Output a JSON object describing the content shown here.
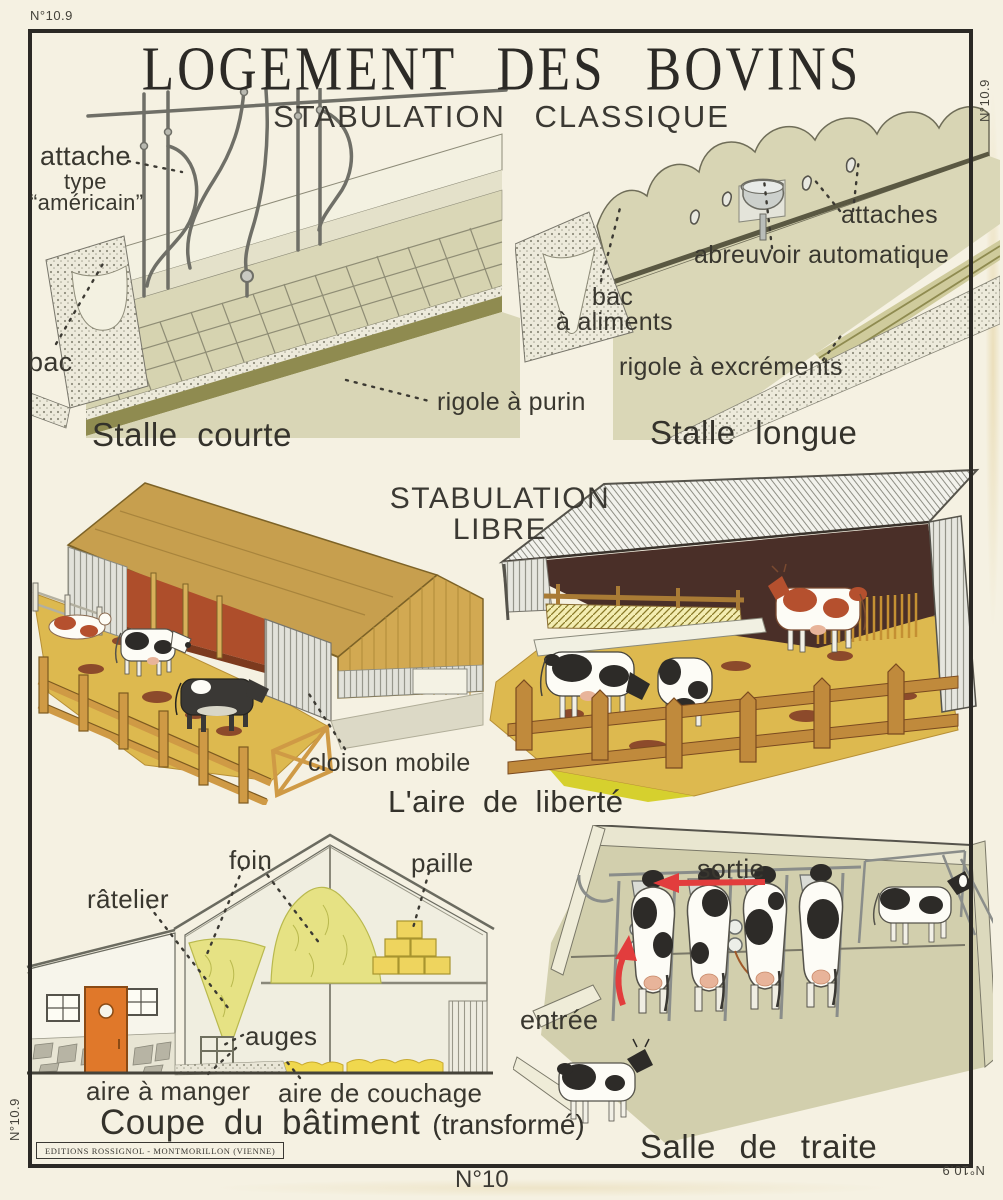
{
  "page": {
    "plate_mark": "N°10.9",
    "sheet_number": "N°10",
    "publisher": "EDITIONS ROSSIGNOL - MONTMORILLON (VIENNE)"
  },
  "header": {
    "title": "LOGEMENT DES BOVINS",
    "subtitle": "STABULATION CLASSIQUE"
  },
  "stalle_courte": {
    "caption": "Stalle courte",
    "label_attache": "attache",
    "label_attache_type_line1": "type",
    "label_attache_type_line2": "“américain”",
    "label_bac": "bac",
    "label_rigole_purin": "rigole à purin"
  },
  "stalle_longue": {
    "caption": "Stalle longue",
    "label_attaches": "attaches",
    "label_abreuvoir": "abreuvoir automatique",
    "label_bac_line1": "bac",
    "label_bac_line2": "à aliments",
    "label_rigole_excrements": "rigole à excréments"
  },
  "stabulation_libre": {
    "heading_line1": "STABULATION",
    "heading_line2": "LIBRE",
    "label_cloison_mobile": "cloison mobile",
    "caption": "L'aire de liberté"
  },
  "coupe_batiment": {
    "caption_main": "Coupe du bâtiment",
    "caption_note": "(transformé)",
    "label_foin": "foin",
    "label_paille": "paille",
    "label_ratelier": "râtelier",
    "label_auges": "auges",
    "label_aire_manger": "aire à manger",
    "label_aire_couchage": "aire de couchage"
  },
  "salle_traite": {
    "caption": "Salle de traite",
    "label_sortie": "sortie",
    "label_entree": "entrée"
  },
  "colors": {
    "paper": "#f5f1e2",
    "ink": "#2c2a26",
    "olive_light": "#dad7b7",
    "olive_dark": "#8f8b50",
    "ochre_roof": "#c79f4e",
    "straw": "#ddb94f",
    "barn_red": "#ae4e2b",
    "door_orange": "#e0782a",
    "hay_yellow": "#e6e284",
    "arrow_red": "#e23d3d",
    "shed_dark": "#4a2f28"
  }
}
